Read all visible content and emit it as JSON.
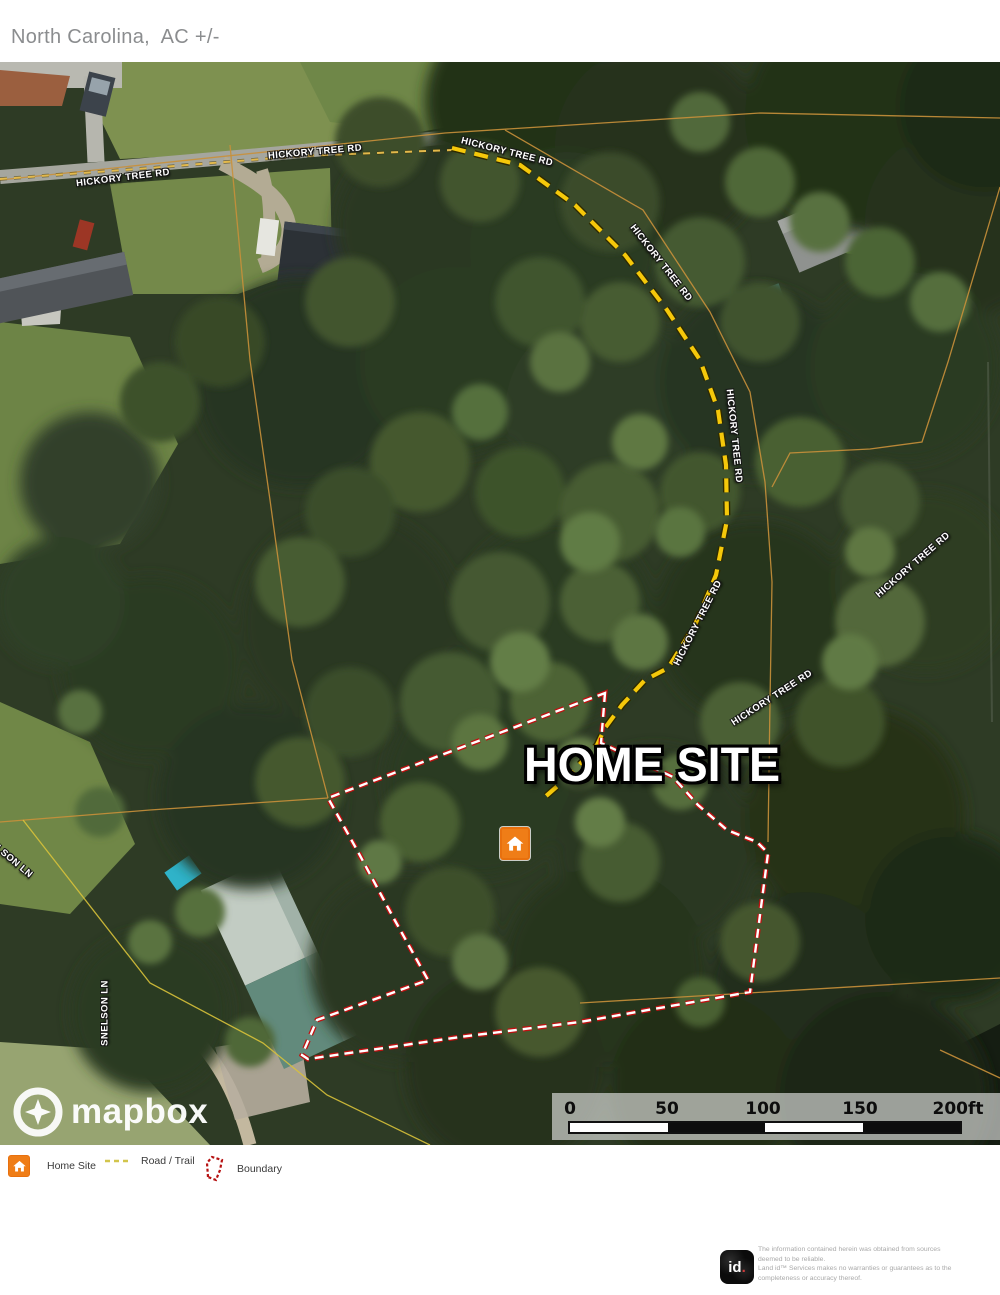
{
  "header": {
    "title": "North Carolina,  AC +/-"
  },
  "map": {
    "title_overlay": "HOME SITE",
    "road_labels": [
      {
        "text": "HICKORY TREE RD",
        "x": 123,
        "y": 116,
        "rot": -7
      },
      {
        "text": "HICKORY TREE RD",
        "x": 315,
        "y": 90,
        "rot": -5
      },
      {
        "text": "HICKORY TREE RD",
        "x": 507,
        "y": 90,
        "rot": 14
      },
      {
        "text": "HICKORY TREE RD",
        "x": 661,
        "y": 201,
        "rot": 52
      },
      {
        "text": "HICKORY TREE RD",
        "x": 734,
        "y": 374,
        "rot": 84
      },
      {
        "text": "HICKORY TREE RD",
        "x": 698,
        "y": 561,
        "rot": -63
      },
      {
        "text": "HICKORY TREE RD",
        "x": 772,
        "y": 636,
        "rot": -33
      },
      {
        "text": "HICKORY TREE RD",
        "x": 913,
        "y": 503,
        "rot": -41
      },
      {
        "text": "SNELSON LN",
        "x": 6,
        "y": 793,
        "rot": 40
      },
      {
        "text": "SNELSON LN",
        "x": 105,
        "y": 951,
        "rot": -90
      }
    ],
    "boundary": {
      "color": "#c01010",
      "dash_color": "#ffffff",
      "points": [
        [
          605,
          631
        ],
        [
          601,
          681
        ],
        [
          673,
          715
        ],
        [
          698,
          743
        ],
        [
          727,
          768
        ],
        [
          757,
          780
        ],
        [
          768,
          791
        ],
        [
          760,
          853
        ],
        [
          750,
          930
        ],
        [
          580,
          960
        ],
        [
          460,
          975
        ],
        [
          308,
          997
        ],
        [
          302,
          993
        ],
        [
          317,
          958
        ],
        [
          428,
          918
        ],
        [
          393,
          855
        ],
        [
          357,
          788
        ],
        [
          328,
          736
        ]
      ]
    },
    "trail": {
      "color": "#f5c80a",
      "road_points": [
        [
          0,
          117
        ],
        [
          150,
          106
        ],
        [
          300,
          94
        ],
        [
          452,
          88
        ]
      ],
      "points": [
        [
          452,
          86
        ],
        [
          520,
          103
        ],
        [
          575,
          143
        ],
        [
          625,
          193
        ],
        [
          667,
          248
        ],
        [
          700,
          298
        ],
        [
          718,
          348
        ],
        [
          726,
          403
        ],
        [
          727,
          458
        ],
        [
          716,
          513
        ],
        [
          695,
          563
        ],
        [
          668,
          606
        ],
        [
          645,
          618
        ],
        [
          622,
          643
        ],
        [
          605,
          666
        ],
        [
          597,
          683
        ],
        [
          570,
          713
        ],
        [
          545,
          735
        ]
      ]
    },
    "parcels": [
      {
        "color": "#c9903a",
        "points": [
          [
            0,
            118
          ],
          [
            445,
            71
          ],
          [
            760,
            51
          ],
          [
            1000,
            56
          ]
        ]
      },
      {
        "color": "#c9903a",
        "points": [
          [
            505,
            68
          ],
          [
            643,
            148
          ],
          [
            710,
            250
          ],
          [
            750,
            330
          ],
          [
            765,
            420
          ],
          [
            772,
            520
          ],
          [
            770,
            640
          ],
          [
            768,
            780
          ]
        ]
      },
      {
        "color": "#c9903a",
        "points": [
          [
            1000,
            125
          ],
          [
            948,
            300
          ],
          [
            922,
            380
          ],
          [
            870,
            387
          ],
          [
            790,
            391
          ],
          [
            772,
            425
          ]
        ]
      },
      {
        "color": "#c9903a",
        "points": [
          [
            230,
            83
          ],
          [
            250,
            298
          ],
          [
            270,
            438
          ],
          [
            292,
            598
          ],
          [
            328,
            736
          ]
        ]
      },
      {
        "color": "#c9903a",
        "points": [
          [
            328,
            736
          ],
          [
            150,
            748
          ],
          [
            0,
            760
          ]
        ]
      },
      {
        "color": "#d8c23a",
        "points": [
          [
            23,
            758
          ],
          [
            150,
            921
          ],
          [
            263,
            981
          ],
          [
            327,
            1033
          ],
          [
            430,
            1083
          ]
        ]
      },
      {
        "color": "#c9903a",
        "points": [
          [
            580,
            941
          ],
          [
            1000,
            916
          ]
        ]
      },
      {
        "color": "#c9903a",
        "points": [
          [
            940,
            988
          ],
          [
            1000,
            1016
          ]
        ]
      }
    ],
    "marker": {
      "x": 500,
      "y": 765,
      "color": "#ef7d17"
    },
    "scalebar": {
      "labels": [
        "0",
        "50",
        "100",
        "150",
        "200ft"
      ],
      "label_x": [
        570,
        667,
        763,
        860,
        958
      ]
    },
    "mapbox": {
      "text": "mapbox"
    }
  },
  "legend": {
    "items": [
      {
        "label": "Home Site"
      },
      {
        "label": "Road / Trail"
      },
      {
        "label": "Boundary"
      }
    ]
  },
  "footer": {
    "logo": {
      "id": "id",
      "dot": "."
    },
    "lines": [
      "The information contained herein was obtained from sources",
      "deemed to be reliable.",
      " Land id™ Services makes no warranties or guarantees as to the",
      "completeness or accuracy thereof."
    ]
  }
}
